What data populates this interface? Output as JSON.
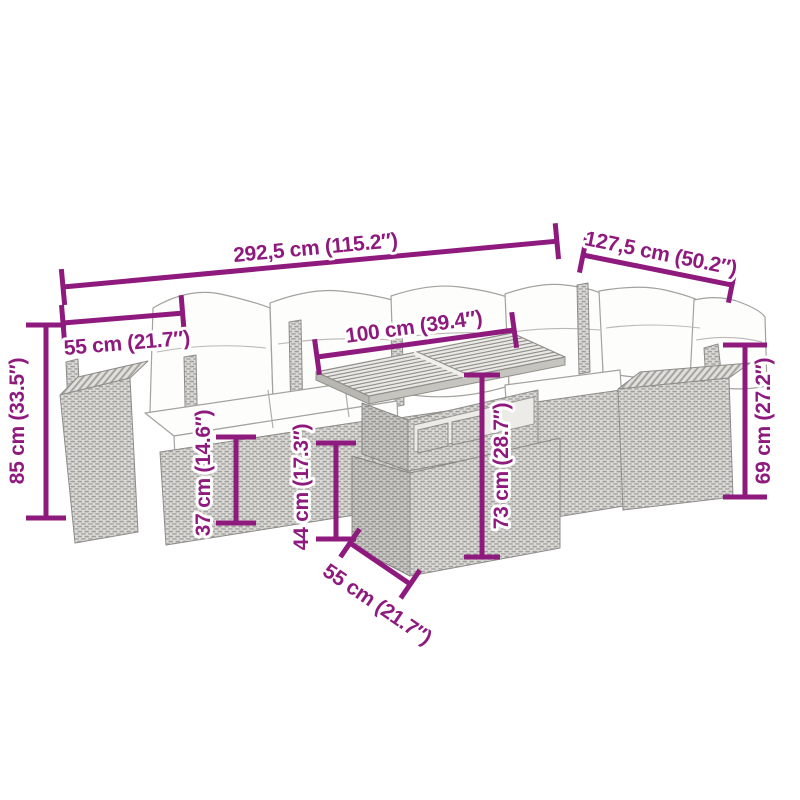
{
  "page": {
    "background": "#ffffff",
    "accent_color": "#8e1a7d"
  },
  "illustration": {
    "description": "Line drawing of a 7-piece poly rattan garden corner sofa set with white cushions and a slatted-top table"
  },
  "dimensions": {
    "overall_width": {
      "label": "292,5 cm (115.2″)"
    },
    "side_depth": {
      "label": "127,5 cm (50.2″)"
    },
    "seat_width": {
      "label": "55 cm (21.7″)"
    },
    "back_height": {
      "label": "85 cm (33.5″)"
    },
    "table_width": {
      "label": "100 cm (39.4″)"
    },
    "seat_height": {
      "label": "37 cm (14.6″)"
    },
    "arm_height": {
      "label": "44 cm (17.3″)"
    },
    "table_height": {
      "label": "73 cm (28.7″)"
    },
    "right_back_height": {
      "label": "69 cm (27.2″)"
    },
    "table_depth": {
      "label": "55 cm (21.7″)"
    }
  }
}
